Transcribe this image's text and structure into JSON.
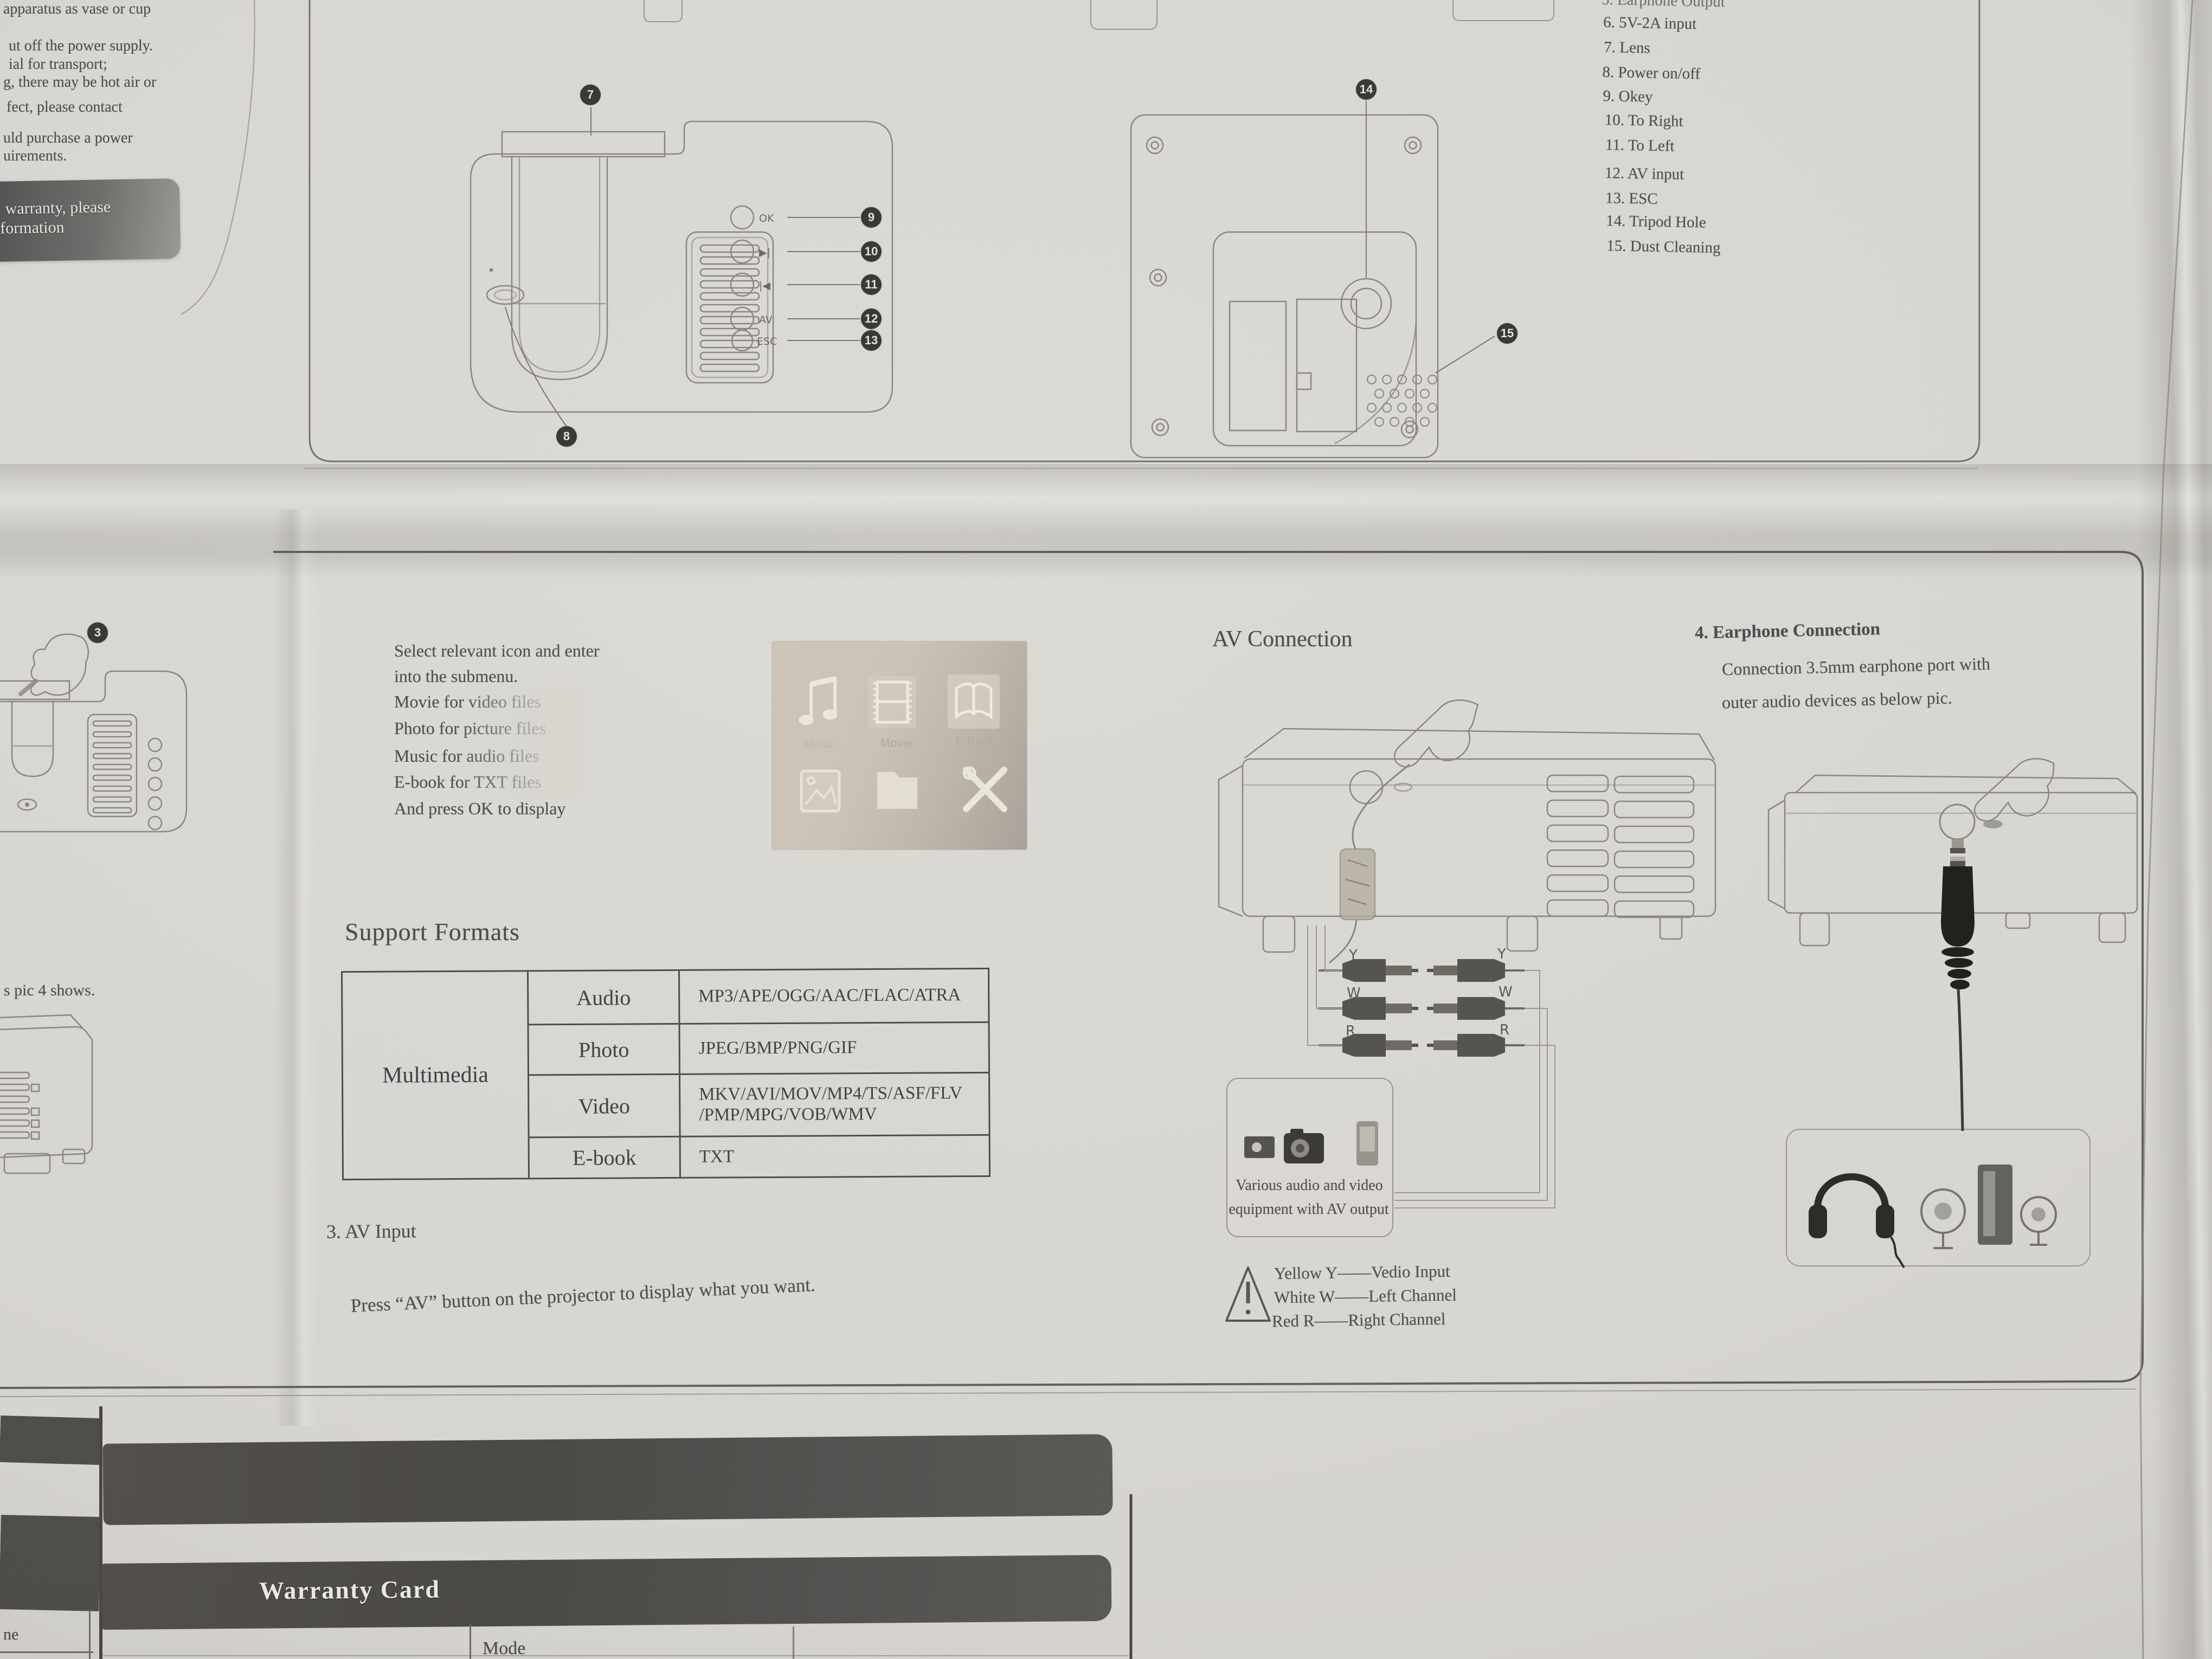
{
  "top_left": {
    "fragments": [
      "apparatus as vase or cup",
      "ut off the power supply.",
      "ial for transport;",
      "g, there may be hot air or",
      "fect, please contact",
      "uld purchase a power",
      "uirements."
    ],
    "warranty_box": {
      "line1": "warranty, please",
      "line2": "formation"
    }
  },
  "parts_list": {
    "items": [
      {
        "label": "5. Earphone Output"
      },
      {
        "label": "6. 5V-2A input"
      },
      {
        "label": "7. Lens"
      },
      {
        "label": "8. Power on/off"
      },
      {
        "label": "9. Okey"
      },
      {
        "label": "10. To Right"
      },
      {
        "label": "11. To Left"
      },
      {
        "label": "12. AV input"
      },
      {
        "label": "13. ESC"
      },
      {
        "label": "14. Tripod Hole"
      },
      {
        "label": "15. Dust Cleaning"
      }
    ]
  },
  "callouts": {
    "c3": "3",
    "c7": "7",
    "c8": "8",
    "c9": "9",
    "c10": "10",
    "c11": "11",
    "c12": "12",
    "c13": "13",
    "c14": "14",
    "c15": "15"
  },
  "diagram_labels": {
    "ok": "OK",
    "next": "▶|",
    "prev": "|◀",
    "av": "AV",
    "esc": "ESC",
    "y": "Y",
    "w": "W",
    "r": "R"
  },
  "submenu": {
    "lines": [
      "Select relevant icon and enter",
      "into the submenu.",
      "Movie for video files",
      "Photo for picture files",
      "Music for audio files",
      "E-book for TXT files",
      "And press OK to display"
    ],
    "menu": {
      "music_label": "Music",
      "movie_label": "Movie",
      "ebook_label": "E-Book"
    }
  },
  "support_formats": {
    "heading": "Support Formats",
    "table": {
      "row_header": "Multimedia",
      "rows": [
        {
          "category": "Audio",
          "formats": "MP3/APE/OGG/AAC/FLAC/ATRA"
        },
        {
          "category": "Photo",
          "formats": "JPEG/BMP/PNG/GIF"
        },
        {
          "category": "Video",
          "formats": "MKV/AVI/MOV/MP4/TS/ASF/FLV\n/PMP/MPG/VOB/WMV"
        },
        {
          "category": "E-book",
          "formats": "TXT"
        }
      ]
    }
  },
  "av_input": {
    "heading": "3. AV Input",
    "body": "Press “AV” button on the projector to display what you want."
  },
  "av_connection": {
    "heading": "AV Connection",
    "equipment_caption_line1": "Various audio and video",
    "equipment_caption_line2": "equipment with AV output",
    "warning_lines": [
      "Yellow Y——Vedio Input",
      "White W——Left Channel",
      "Red R——Right Channel"
    ]
  },
  "earphone": {
    "heading": "4. Earphone Connection",
    "line2": "Connection 3.5mm earphone port with",
    "line3": "outer audio devices as below pic."
  },
  "left_column": {
    "pic4_text": "s pic 4 shows."
  },
  "warranty_section": {
    "title": "Warranty Card",
    "mode_label": "Mode",
    "left_fragment": "ne"
  },
  "icons": {
    "music-note-icon": "♫",
    "movie-film-icon": "film-strip-shape",
    "ebook-icon": "open-book-shape",
    "photo-icon": "picture-frame-shape",
    "folder-icon": "folder-shape",
    "settings-tools-icon": "crossed-tools-shape",
    "warning-icon": "exclamation-triangle-shape",
    "headphones-icon": "headphones-shape",
    "speakers-icon": "speaker-set-shape",
    "pointing-hand-icon": "hand-outline-shape",
    "power-icon": "power-oval-shape"
  }
}
